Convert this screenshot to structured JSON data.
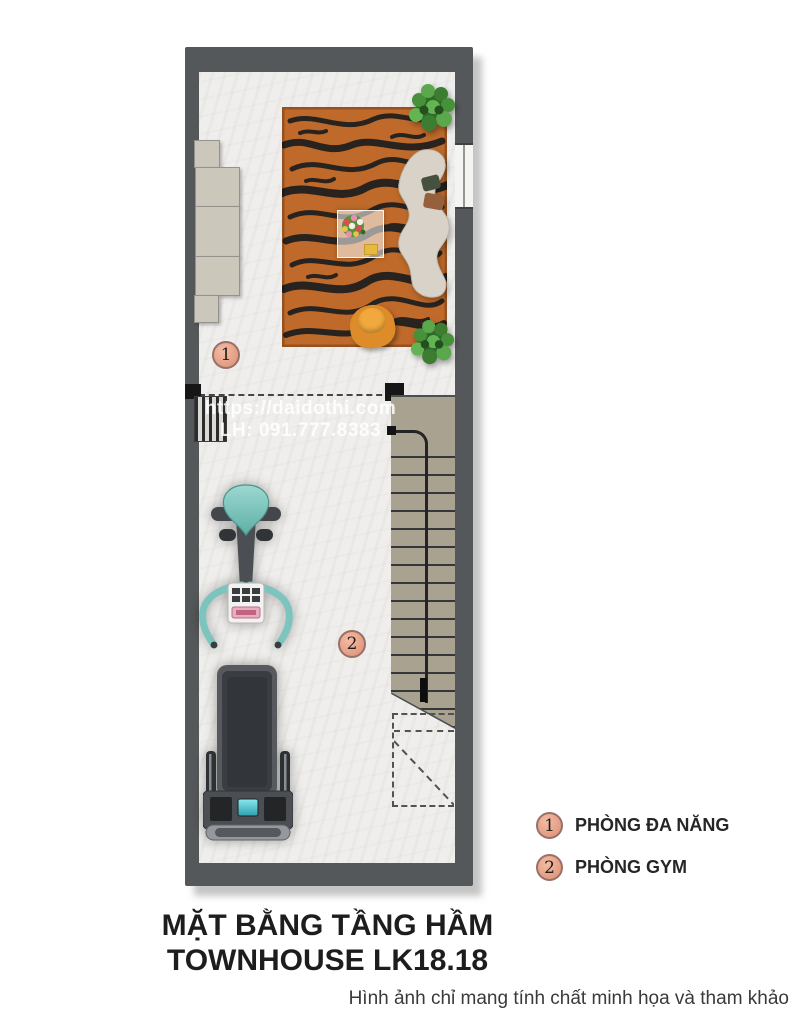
{
  "watermark": {
    "line1": "https://daidothi.com",
    "line2": "LH: 091.777.8383"
  },
  "plan": {
    "badge1": "1",
    "badge2": "2",
    "furniture_icons": [
      "sideboard",
      "tiger-print-rug",
      "coffee-table-with-flowers",
      "curved-sofa",
      "potted-plant",
      "lounge-chair",
      "exercise-bike",
      "treadmill",
      "staircase",
      "under-stair-void",
      "vent-grille",
      "window"
    ]
  },
  "legend": {
    "items": [
      {
        "num": "1",
        "label": "PHÒNG ĐA NĂNG"
      },
      {
        "num": "2",
        "label": "PHÒNG GYM"
      }
    ]
  },
  "title": {
    "line1": "MẶT BẰNG TẦNG HẦM",
    "line2": "TOWNHOUSE LK18.18"
  },
  "disclaimer": "Hình ảnh chỉ mang tính chất minh họa và tham khảo",
  "colors": {
    "wall": "#55585a",
    "floor": "#efeeec",
    "stair": "#a9a290",
    "rug_orange": "#bf6a2a",
    "rug_stripe": "#29231f",
    "sofa_cream": "#d8d2c8",
    "equipment_teal": "#7cc4bd",
    "equipment_dark": "#4b4e52",
    "badge_fill": "#e8a58c",
    "badge_border": "#99706a",
    "title_text": "#1d1d1d"
  }
}
